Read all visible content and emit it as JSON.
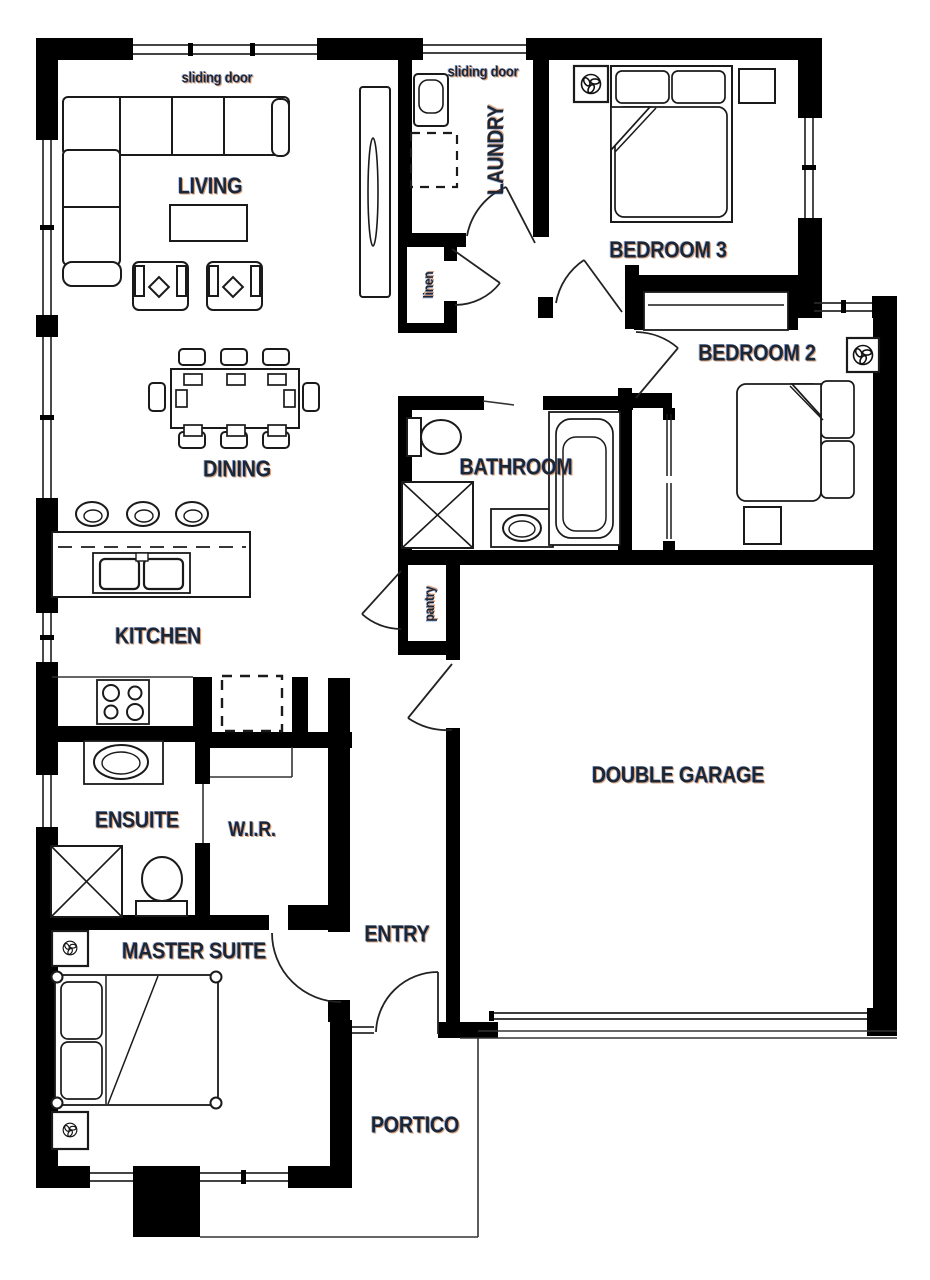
{
  "rooms": {
    "living": "LIVING",
    "laundry": "LAUNDRY",
    "bedroom3": "BEDROOM 3",
    "bedroom2": "BEDROOM 2",
    "dining": "DINING",
    "bathroom": "BATHROOM",
    "kitchen": "KITCHEN",
    "double_garage": "DOUBLE GARAGE",
    "ensuite": "ENSUITE",
    "wir": "W.I.R.",
    "master_suite": "MASTER SUITE",
    "entry": "ENTRY",
    "portico": "PORTICO"
  },
  "annotations": {
    "sliding_door_living": "sliding door",
    "sliding_door_laundry": "sliding door",
    "linen": "linen",
    "pantry": "pantry"
  },
  "colors": {
    "wall": "#000000",
    "furniture_line": "#1a1a1a",
    "label": "#1d2633"
  }
}
